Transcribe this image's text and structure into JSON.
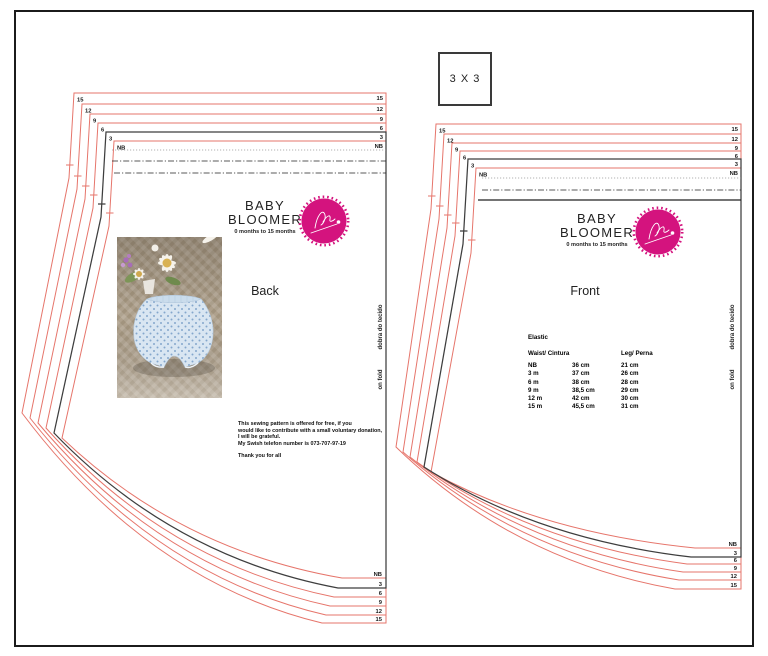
{
  "document": {
    "scale_box_label": "3 X 3",
    "brand": {
      "title_line1": "BABY",
      "title_line2": "BLOOMER",
      "subtitle": "0 months to 15 months"
    },
    "fold_label_pt": "dobra do tecido",
    "fold_label_en": "on fold",
    "sizes_top_to_bottom": [
      "15",
      "12",
      "9",
      "6",
      "3",
      "NB"
    ],
    "back": {
      "label": "Back",
      "donation_text_lines": [
        "This sewing pattern is offered for free, if you",
        "would like to contribute with a small voluntary donation,",
        "I will be grateful.",
        "My Swish telefon number is 073-707-97-19",
        "",
        "Thank you for all"
      ]
    },
    "front": {
      "label": "Front",
      "elastic_table": {
        "title": "Elastic",
        "headers": [
          "Waist/ Cintura",
          "Leg/ Perna"
        ],
        "rows": [
          [
            "NB",
            "36 cm",
            "21 cm"
          ],
          [
            "3 m",
            "37 cm",
            "26 cm"
          ],
          [
            "6 m",
            "38 cm",
            "28 cm"
          ],
          [
            "9 m",
            "38,5 cm",
            "29 cm"
          ],
          [
            "12 m",
            "42 cm",
            "30 cm"
          ],
          [
            "15 m",
            "45,5 cm",
            "31 cm"
          ]
        ]
      }
    },
    "colors": {
      "size_line_red": "#e6756b",
      "size3_line_black": "#3e3e3e",
      "dash_black": "#222222",
      "dot_gray": "#999999",
      "logo_pink": "#d4137e",
      "page_border": "#1b1b1b"
    }
  }
}
